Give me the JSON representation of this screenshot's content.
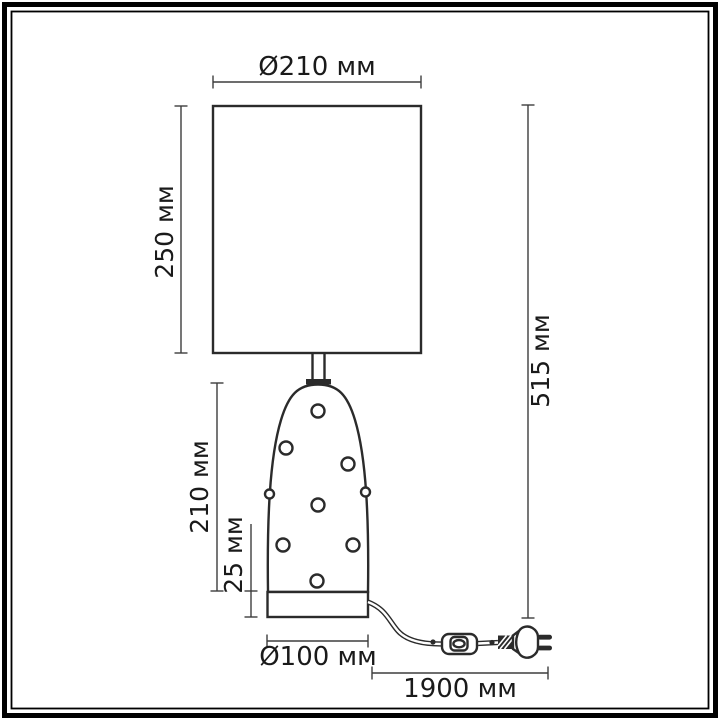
{
  "labels": {
    "shade_diameter": "Ø210 мм",
    "shade_height": "250 мм",
    "body_height": "210 мм",
    "base_height": "25 мм",
    "total_height": "515 мм",
    "base_diameter": "Ø100 мм",
    "cord_length": "1900 мм"
  },
  "colors": {
    "line": "#2b2b2b",
    "dim": "#3d3d3d",
    "text": "#1a1a1a",
    "bg": "#ffffff",
    "frame": "#000000"
  }
}
